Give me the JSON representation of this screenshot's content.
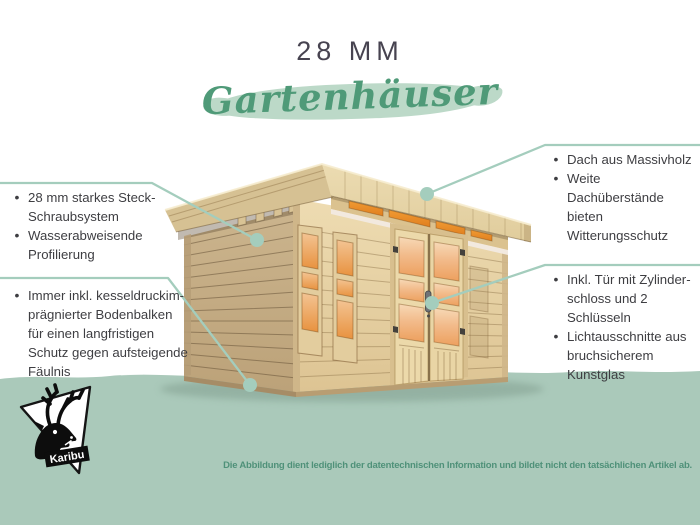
{
  "header": {
    "title": "28 MM",
    "subtitle": "Gartenhäuser"
  },
  "callouts": {
    "left_top": {
      "items": [
        "28 mm starkes Steck-\nSchraubsystem",
        "Wasserabweisende\nProfilierung"
      ]
    },
    "left_bottom": {
      "items": [
        "Immer inkl. kesseldruckim-\nprägnierter Bodenbalken\nfür einen langfristigen\nSchutz gegen aufsteigende\nFäulnis"
      ]
    },
    "right_top": {
      "items": [
        "Dach aus Massivholz",
        "Weite Dachüberstände\nbieten Witterungsschutz"
      ]
    },
    "right_bottom": {
      "items": [
        "Inkl. Tür mit Zylinder-\nschloss und 2 Schlüsseln",
        "Lichtausschnitte aus\nbruchsicherem Kunstglas"
      ]
    }
  },
  "footer": {
    "disclaimer": "Die Abbildung dient lediglich der datentechnischen Information und bildet nicht den tatsächlichen Artikel ab."
  },
  "logo": {
    "brand": "Karibu",
    "icon": "deer-head-icon"
  },
  "colors": {
    "accent_green": "#4f9a78",
    "brush_green": "#bcd9c8",
    "band_green": "#aac9ba",
    "callout_line": "#a4cdbd",
    "body_text": "#3e3e42",
    "title_text": "#474350",
    "disclaimer_text": "#4f9179",
    "wood_light": "#eedcb2",
    "wood_shade": "#bca279",
    "glass_orange": "#eda05e",
    "transom_orange": "#e8882a"
  }
}
